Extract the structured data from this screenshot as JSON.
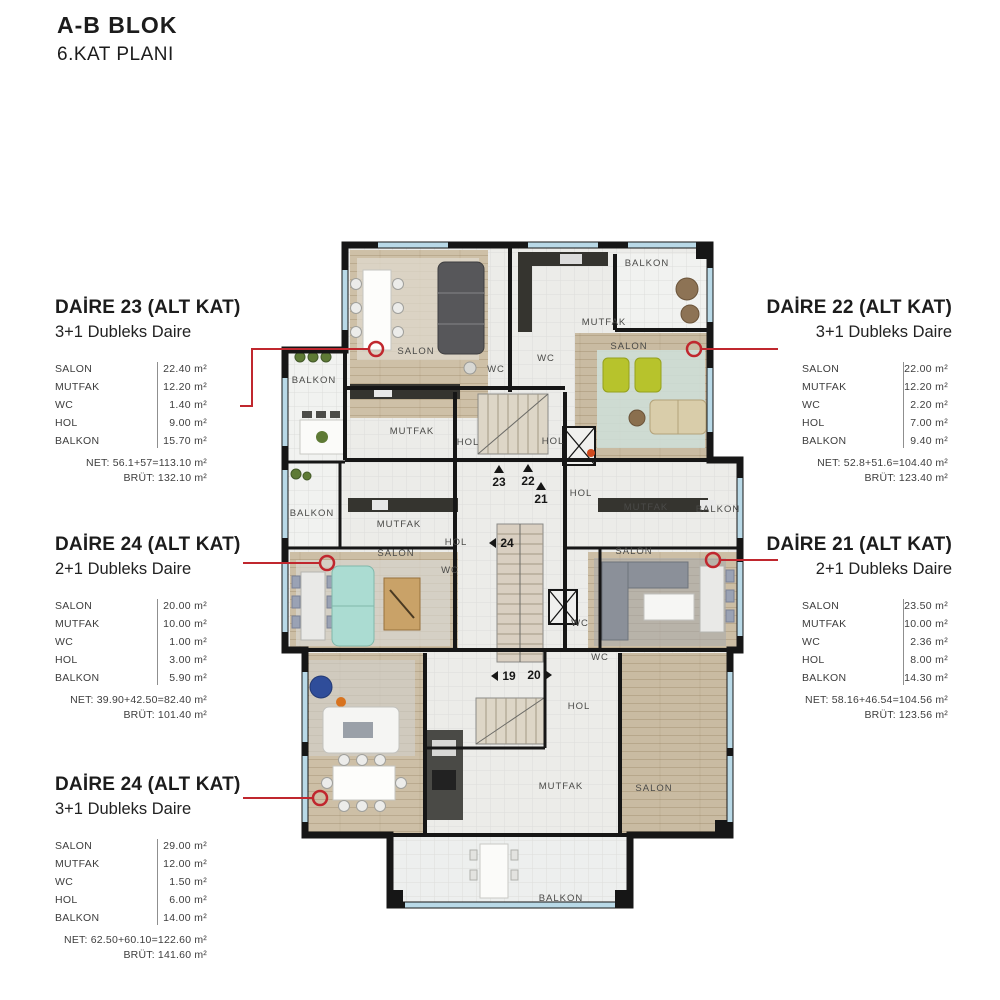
{
  "header": {
    "title": "A-B BLOK",
    "subtitle": "6.KAT PLANI"
  },
  "panels": [
    {
      "id": "daire-23",
      "side": "left",
      "title": "DAİRE 23 (ALT KAT)",
      "subtitle": "3+1 Dubleks Daire",
      "rooms": [
        {
          "label": "SALON",
          "value": "22.40 m²"
        },
        {
          "label": "MUTFAK",
          "value": "12.20 m²"
        },
        {
          "label": "WC",
          "value": "1.40 m²"
        },
        {
          "label": "HOL",
          "value": "9.00 m²"
        },
        {
          "label": "BALKON",
          "value": "15.70 m²"
        }
      ],
      "net": "NET: 56.1+57=113.10 m²",
      "brut": "BRÜT: 132.10 m²"
    },
    {
      "id": "daire-22",
      "side": "right",
      "title": "DAİRE 22 (ALT KAT)",
      "subtitle": "3+1 Dubleks Daire",
      "rooms": [
        {
          "label": "SALON",
          "value": "22.00 m²"
        },
        {
          "label": "MUTFAK",
          "value": "12.20 m²"
        },
        {
          "label": "WC",
          "value": "2.20 m²"
        },
        {
          "label": "HOL",
          "value": "7.00 m²"
        },
        {
          "label": "BALKON",
          "value": "9.40 m²"
        }
      ],
      "net": "NET: 52.8+51.6=104.40 m²",
      "brut": "BRÜT: 123.40 m²"
    },
    {
      "id": "daire-24-orta",
      "side": "left",
      "title": "DAİRE 24 (ALT KAT)",
      "subtitle": "2+1 Dubleks Daire",
      "rooms": [
        {
          "label": "SALON",
          "value": "20.00 m²"
        },
        {
          "label": "MUTFAK",
          "value": "10.00 m²"
        },
        {
          "label": "WC",
          "value": "1.00 m²"
        },
        {
          "label": "HOL",
          "value": "3.00 m²"
        },
        {
          "label": "BALKON",
          "value": "5.90 m²"
        }
      ],
      "net": "NET: 39.90+42.50=82.40 m²",
      "brut": "BRÜT: 101.40 m²"
    },
    {
      "id": "daire-21",
      "side": "right",
      "title": "DAİRE 21 (ALT KAT)",
      "subtitle": "2+1 Dubleks Daire",
      "rooms": [
        {
          "label": "SALON",
          "value": "23.50 m²"
        },
        {
          "label": "MUTFAK",
          "value": "10.00 m²"
        },
        {
          "label": "WC",
          "value": "2.36 m²"
        },
        {
          "label": "HOL",
          "value": "8.00 m²"
        },
        {
          "label": "BALKON",
          "value": "14.30 m²"
        }
      ],
      "net": "NET: 58.16+46.54=104.56 m²",
      "brut": "BRÜT: 123.56 m²"
    },
    {
      "id": "daire-24-alt",
      "side": "left",
      "title": "DAİRE 24 (ALT KAT)",
      "subtitle": "3+1 Dubleks Daire",
      "rooms": [
        {
          "label": "SALON",
          "value": "29.00 m²"
        },
        {
          "label": "MUTFAK",
          "value": "12.00 m²"
        },
        {
          "label": "WC",
          "value": "1.50 m²"
        },
        {
          "label": "HOL",
          "value": "6.00 m²"
        },
        {
          "label": "BALKON",
          "value": "14.00 m²"
        }
      ],
      "net": "NET: 62.50+60.10=122.60 m²",
      "brut": "BRÜT: 141.60 m²"
    }
  ],
  "plan": {
    "room_labels": [
      {
        "text": "BALKON",
        "x": 647,
        "y": 266
      },
      {
        "text": "MUTFAK",
        "x": 604,
        "y": 325
      },
      {
        "text": "SALON",
        "x": 629,
        "y": 349
      },
      {
        "text": "WC",
        "x": 546,
        "y": 361
      },
      {
        "text": "SALON",
        "x": 416,
        "y": 354
      },
      {
        "text": "WC",
        "x": 496,
        "y": 372
      },
      {
        "text": "BALKON",
        "x": 314,
        "y": 383
      },
      {
        "text": "MUTFAK",
        "x": 412,
        "y": 434
      },
      {
        "text": "HOL",
        "x": 468,
        "y": 445
      },
      {
        "text": "HOL",
        "x": 553,
        "y": 444
      },
      {
        "text": "HOL",
        "x": 581,
        "y": 496
      },
      {
        "text": "MUTFAK",
        "x": 646,
        "y": 510
      },
      {
        "text": "BALKON",
        "x": 718,
        "y": 512
      },
      {
        "text": "BALKON",
        "x": 312,
        "y": 516
      },
      {
        "text": "MUTFAK",
        "x": 399,
        "y": 527
      },
      {
        "text": "HOL",
        "x": 456,
        "y": 545
      },
      {
        "text": "SALON",
        "x": 396,
        "y": 556
      },
      {
        "text": "SALON",
        "x": 634,
        "y": 554
      },
      {
        "text": "WC",
        "x": 450,
        "y": 573
      },
      {
        "text": "WC",
        "x": 580,
        "y": 626
      },
      {
        "text": "WC",
        "x": 600,
        "y": 660
      },
      {
        "text": "HOL",
        "x": 579,
        "y": 709
      },
      {
        "text": "MUTFAK",
        "x": 561,
        "y": 789
      },
      {
        "text": "SALON",
        "x": 654,
        "y": 791
      },
      {
        "text": "BALKON",
        "x": 561,
        "y": 901
      }
    ],
    "unit_markers": [
      {
        "text": "23",
        "x": 499,
        "y": 486,
        "arrow": "up"
      },
      {
        "text": "22",
        "x": 528,
        "y": 485,
        "arrow": "up"
      },
      {
        "text": "21",
        "x": 541,
        "y": 503,
        "arrow": "up"
      },
      {
        "text": "24",
        "x": 507,
        "y": 547,
        "arrow": "left"
      },
      {
        "text": "19",
        "x": 509,
        "y": 680,
        "arrow": "left"
      },
      {
        "text": "20",
        "x": 534,
        "y": 679,
        "arrow": "right"
      }
    ],
    "callouts": [
      {
        "unit": "23",
        "points": "240,406 252,406 252,349 369,349",
        "cx": 376,
        "cy": 349
      },
      {
        "unit": "22",
        "points": "778,349 701,349",
        "cx": 694,
        "cy": 349
      },
      {
        "unit": "24",
        "points": "243,563 319,563",
        "cx": 327,
        "cy": 563
      },
      {
        "unit": "21",
        "points": "778,560 721,560",
        "cx": 713,
        "cy": 560
      },
      {
        "unit": "24b",
        "points": "243,798 312,798",
        "cx": 320,
        "cy": 798
      }
    ],
    "colors": {
      "accent_red": "#c0272e",
      "wall": "#161616",
      "wood_floor": "#cec0a7",
      "tile_floor": "#ecece9",
      "window_blue": "#b9d9e7",
      "lime_chair": "#b7c32c",
      "teal_sofa": "#abdcd2",
      "blue_chair": "#2f4d9a"
    }
  }
}
